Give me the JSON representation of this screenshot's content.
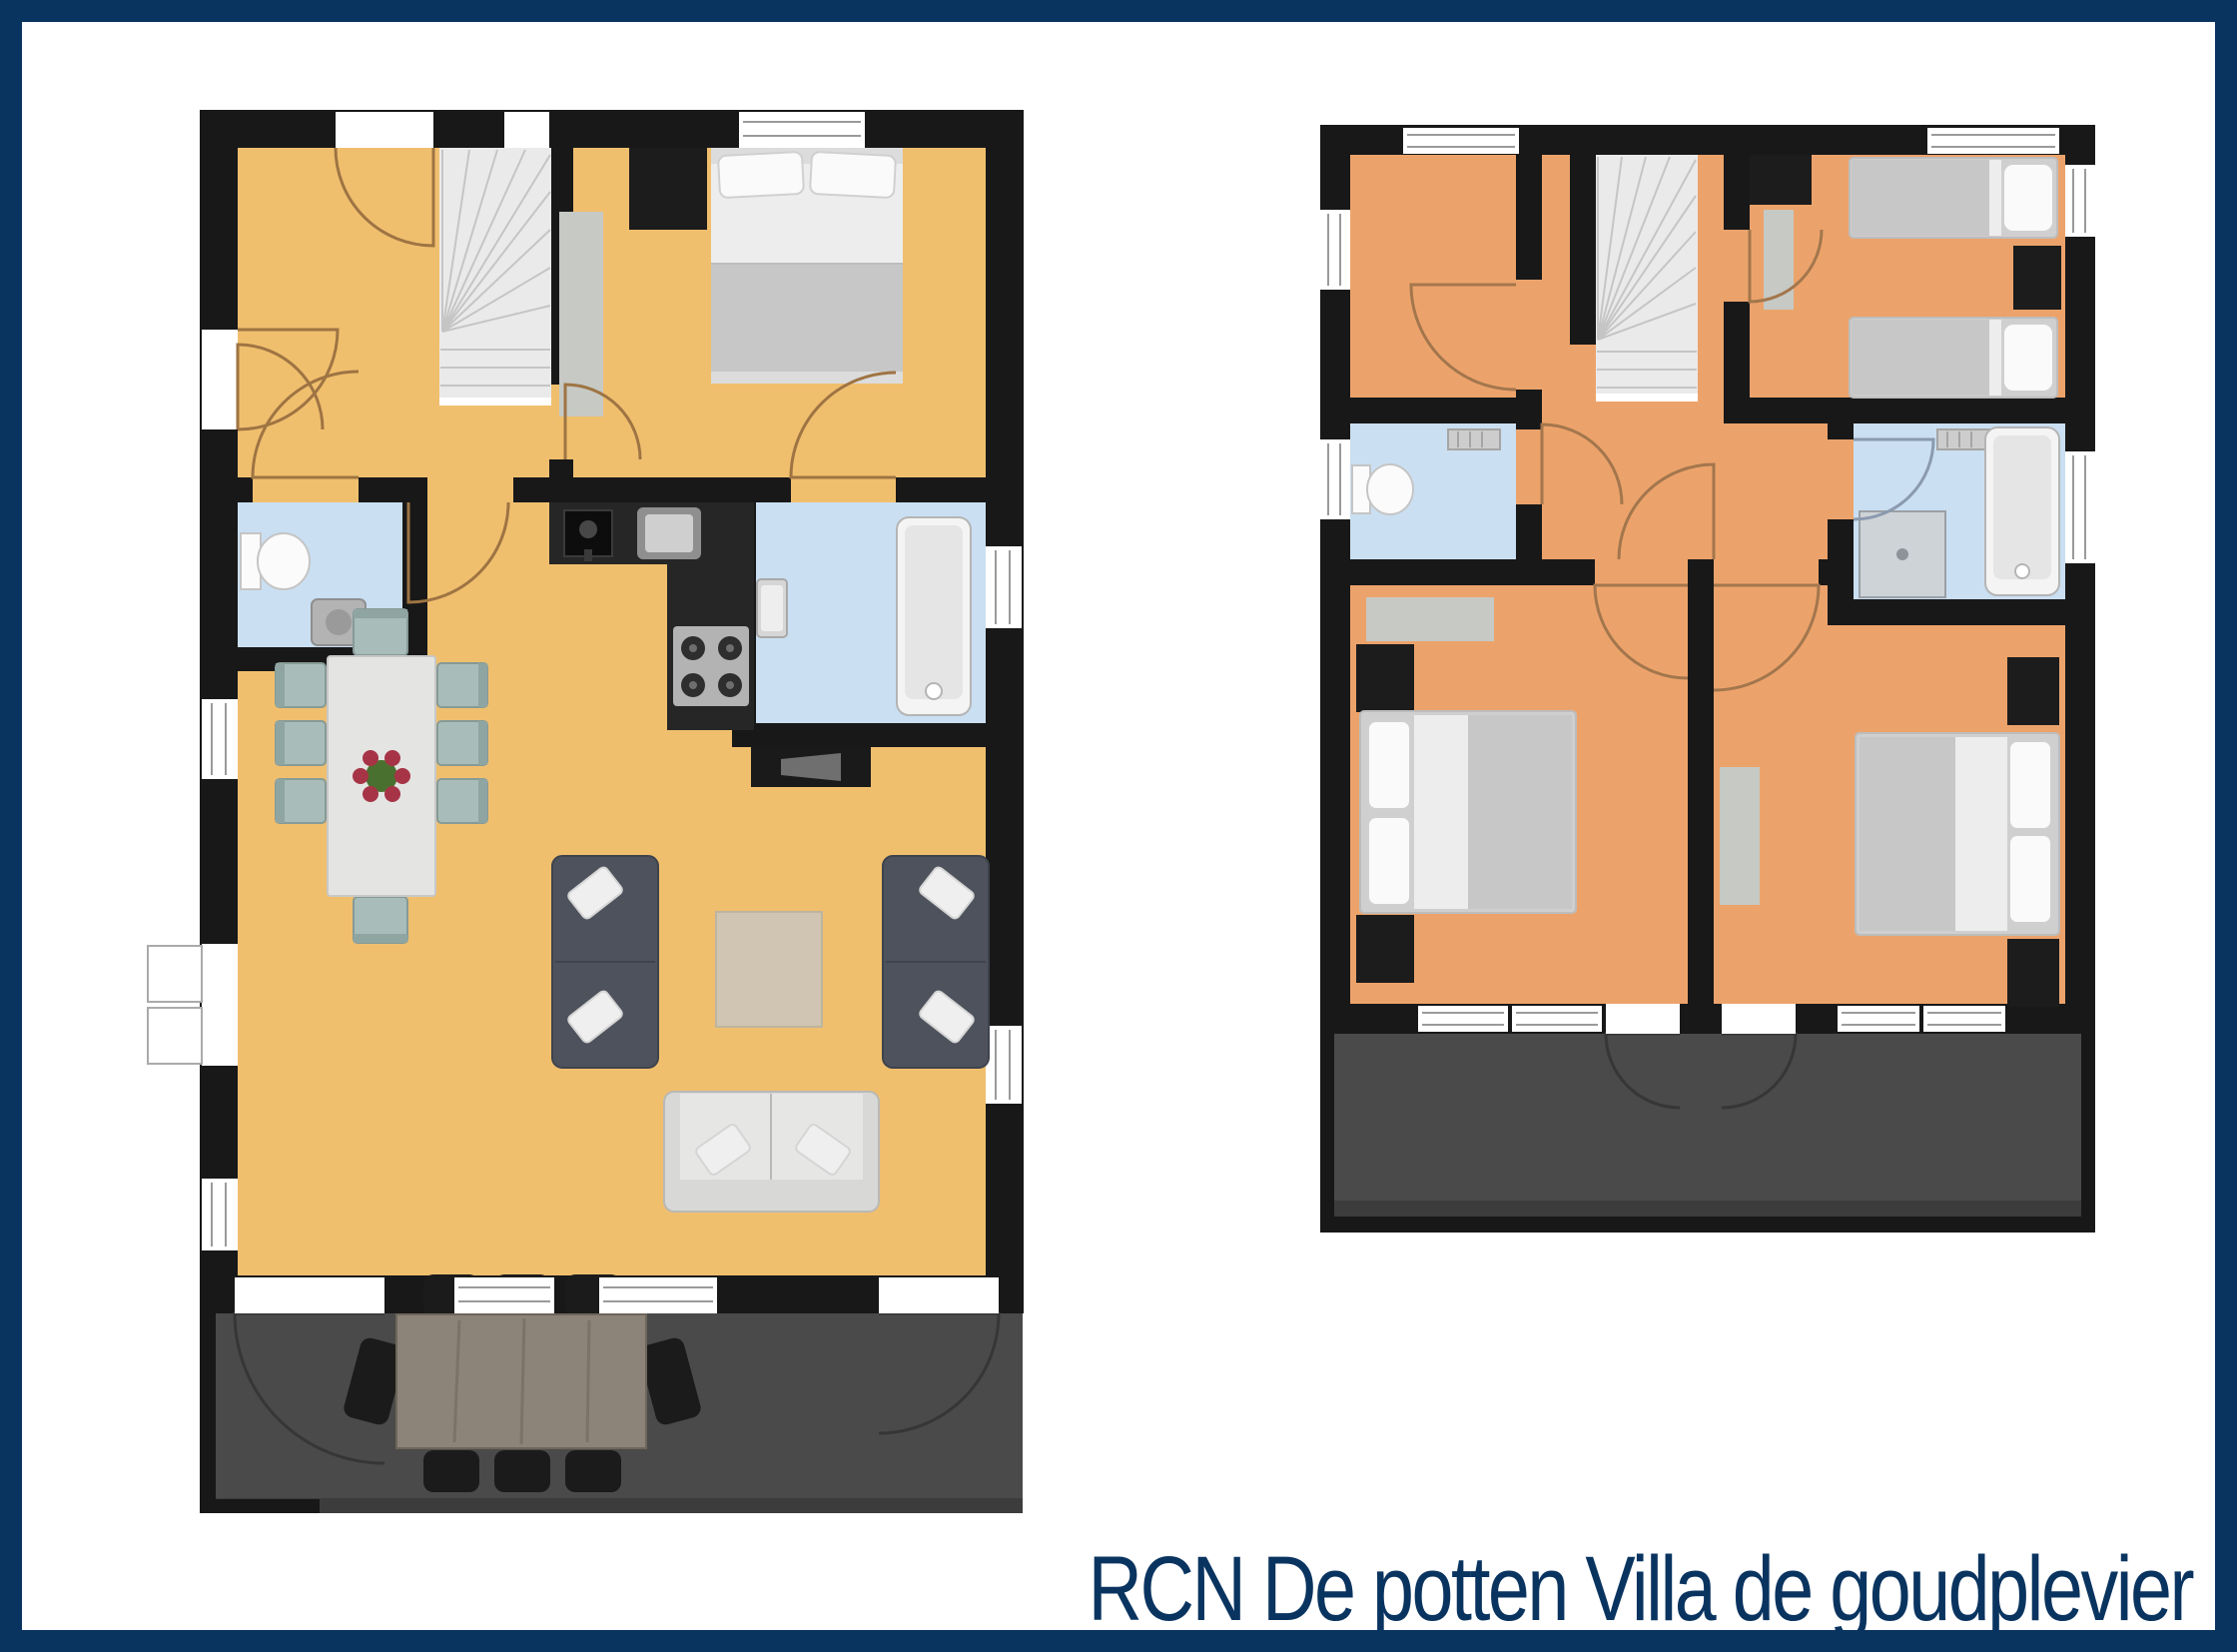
{
  "title": "RCN De potten Villa de goudplevier",
  "colors": {
    "frame": "#0a3460",
    "background": "#ffffff",
    "wall": "#181818",
    "floor_ground": "#f0bf6e",
    "floor_upper": "#eca36b",
    "bathroom_floor": "#cadff2",
    "terrace": "#4a4a4a",
    "terrace_edge": "#3c3c3c",
    "stairs": "#eaeaea",
    "door_arc_ground": "#9e7443",
    "door_arc_upper": "#a3764d",
    "sofa_dark": "#4d525c",
    "sofa_light": "#d8d8d6",
    "dining_chair": "#a8bdb9",
    "rug_living": "#cfc5b2",
    "rug_gray": "#c6c9c4",
    "outdoor_table": "#8c8478",
    "outdoor_chair": "#1b1b1b",
    "kitchen_counter": "#262626",
    "bed_blanket": "#c7c7c7",
    "bed_sheet": "#ededed",
    "pillow": "#fafafa",
    "furniture_dark": "#1c1c1c"
  },
  "floors": [
    {
      "id": "ground-floor",
      "position": "left"
    },
    {
      "id": "first-floor",
      "position": "right"
    }
  ]
}
